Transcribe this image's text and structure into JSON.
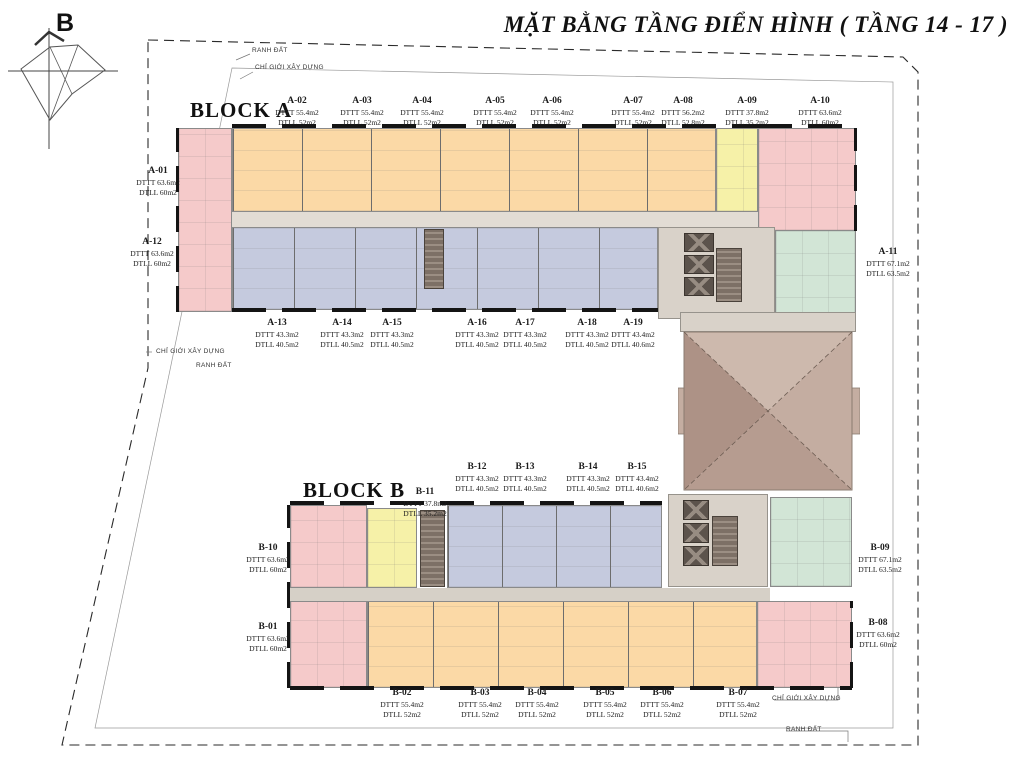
{
  "title": "MẶT BẰNG TẦNG ĐIỂN HÌNH ( TẦNG 14 - 17 )",
  "compass": {
    "label": "B"
  },
  "annotations": {
    "boundary": "RANH ĐẤT",
    "construction": "CHỈ GIỚI XÂY DỰNG"
  },
  "colors": {
    "unit_pink": "#f5caca",
    "unit_orange": "#fbd9a6",
    "unit_yellow": "#f6f1a8",
    "unit_blue": "#c5cade",
    "unit_green": "#d2e5d6",
    "core_beige": "#d9d2c9",
    "roof_brown": "#c4ada1",
    "wall_black": "#141414"
  },
  "blocks": {
    "a": {
      "label": "BLOCK A",
      "units": [
        {
          "id": "A-01",
          "dttt": "DTTT 63.6m2",
          "dtll": "DTLL 60m2"
        },
        {
          "id": "A-02",
          "dttt": "DTTT 55.4m2",
          "dtll": "DTLL 52m2"
        },
        {
          "id": "A-03",
          "dttt": "DTTT 55.4m2",
          "dtll": "DTLL 52m2"
        },
        {
          "id": "A-04",
          "dttt": "DTTT 55.4m2",
          "dtll": "DTLL 52m2"
        },
        {
          "id": "A-05",
          "dttt": "DTTT 55.4m2",
          "dtll": "DTLL 52m2"
        },
        {
          "id": "A-06",
          "dttt": "DTTT 55.4m2",
          "dtll": "DTLL 52m2"
        },
        {
          "id": "A-07",
          "dttt": "DTTT 55.4m2",
          "dtll": "DTLL 52m2"
        },
        {
          "id": "A-08",
          "dttt": "DTTT 56.2m2",
          "dtll": "DTLL 52.8m2"
        },
        {
          "id": "A-09",
          "dttt": "DTTT 37.8m2",
          "dtll": "DTLL 35.2m2"
        },
        {
          "id": "A-10",
          "dttt": "DTTT 63.6m2",
          "dtll": "DTLL 60m2"
        },
        {
          "id": "A-11",
          "dttt": "DTTT 67.1m2",
          "dtll": "DTLL 63.5m2"
        },
        {
          "id": "A-12",
          "dttt": "DTTT 63.6m2",
          "dtll": "DTLL 60m2"
        },
        {
          "id": "A-13",
          "dttt": "DTTT 43.3m2",
          "dtll": "DTLL 40.5m2"
        },
        {
          "id": "A-14",
          "dttt": "DTTT 43.3m2",
          "dtll": "DTLL 40.5m2"
        },
        {
          "id": "A-15",
          "dttt": "DTTT 43.3m2",
          "dtll": "DTLL 40.5m2"
        },
        {
          "id": "A-16",
          "dttt": "DTTT 43.3m2",
          "dtll": "DTLL 40.5m2"
        },
        {
          "id": "A-17",
          "dttt": "DTTT 43.3m2",
          "dtll": "DTLL 40.5m2"
        },
        {
          "id": "A-18",
          "dttt": "DTTT 43.3m2",
          "dtll": "DTLL 40.5m2"
        },
        {
          "id": "A-19",
          "dttt": "DTTT 43.4m2",
          "dtll": "DTLL 40.6m2"
        }
      ]
    },
    "b": {
      "label": "BLOCK B",
      "units": [
        {
          "id": "B-01",
          "dttt": "DTTT 63.6m2",
          "dtll": "DTLL 60m2"
        },
        {
          "id": "B-02",
          "dttt": "DTTT 55.4m2",
          "dtll": "DTLL 52m2"
        },
        {
          "id": "B-03",
          "dttt": "DTTT 55.4m2",
          "dtll": "DTLL 52m2"
        },
        {
          "id": "B-04",
          "dttt": "DTTT 55.4m2",
          "dtll": "DTLL 52m2"
        },
        {
          "id": "B-05",
          "dttt": "DTTT 55.4m2",
          "dtll": "DTLL 52m2"
        },
        {
          "id": "B-06",
          "dttt": "DTTT 55.4m2",
          "dtll": "DTLL 52m2"
        },
        {
          "id": "B-07",
          "dttt": "DTTT 55.4m2",
          "dtll": "DTLL 52m2"
        },
        {
          "id": "B-08",
          "dttt": "DTTT 63.6m2",
          "dtll": "DTLL 60m2"
        },
        {
          "id": "B-09",
          "dttt": "DTTT 67.1m2",
          "dtll": "DTLL 63.5m2"
        },
        {
          "id": "B-10",
          "dttt": "DTTT 63.6m2",
          "dtll": "DTLL 60m2"
        },
        {
          "id": "B-11",
          "dttt": "DTTT 37.8m2",
          "dtll": "DTLL 35.2m2"
        },
        {
          "id": "B-12",
          "dttt": "DTTT 43.3m2",
          "dtll": "DTLL 40.5m2"
        },
        {
          "id": "B-13",
          "dttt": "DTTT 43.3m2",
          "dtll": "DTLL 40.5m2"
        },
        {
          "id": "B-14",
          "dttt": "DTTT 43.3m2",
          "dtll": "DTLL 40.5m2"
        },
        {
          "id": "B-15",
          "dttt": "DTTT 43.4m2",
          "dtll": "DTLL 40.6m2"
        }
      ]
    }
  }
}
